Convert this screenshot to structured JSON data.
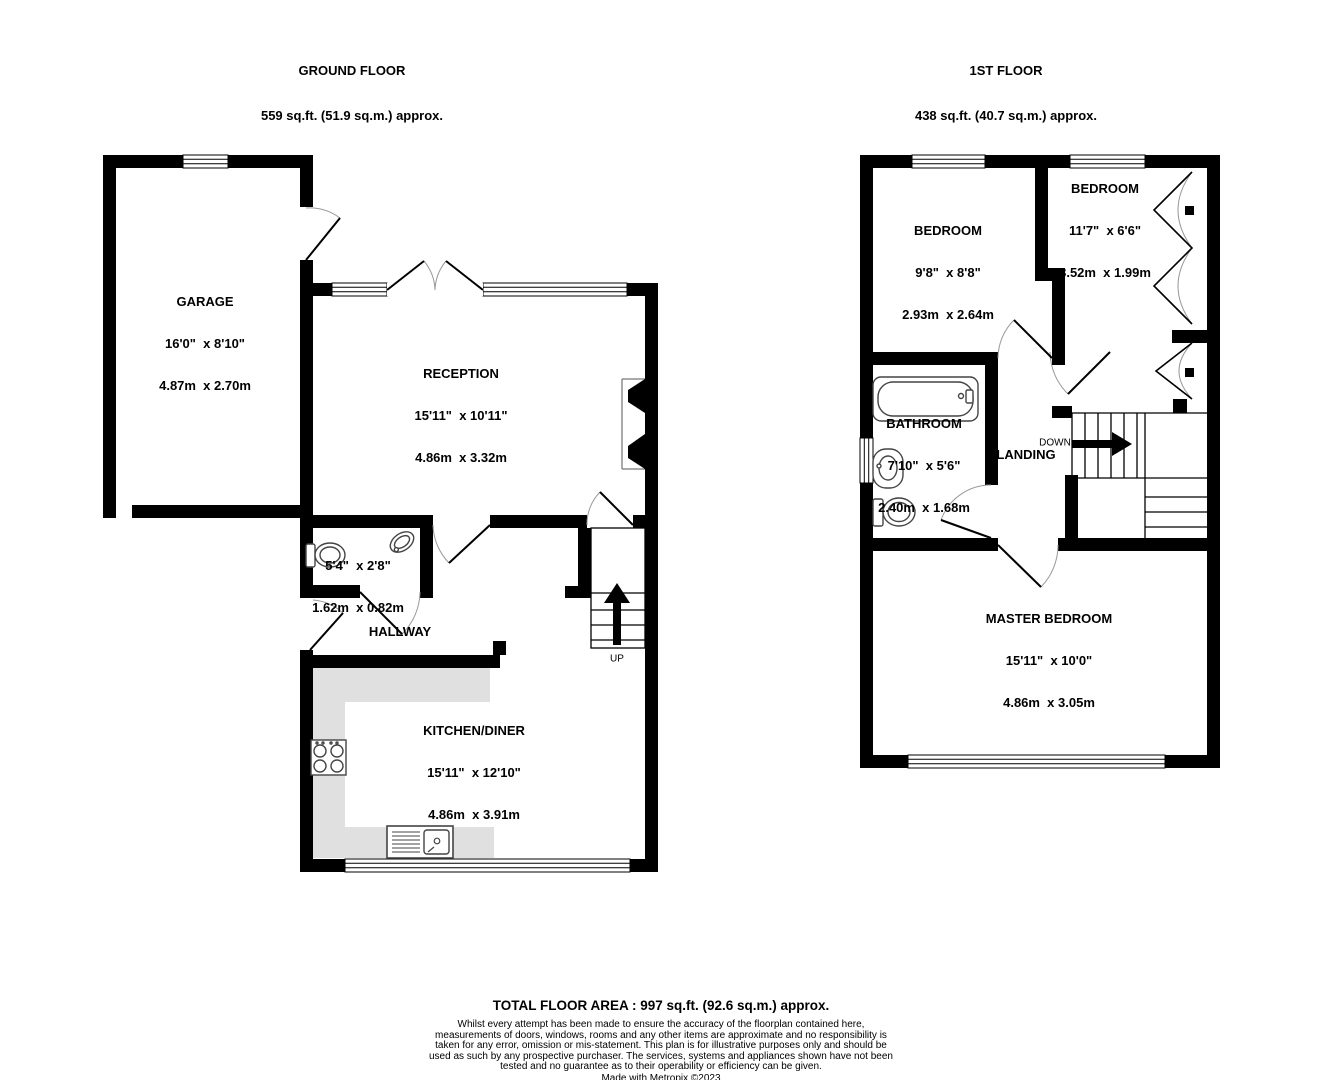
{
  "colors": {
    "wall": "#000000",
    "counter": "#e0e0e0",
    "arc": "#999999"
  },
  "ground_floor": {
    "title": "GROUND FLOOR",
    "area": "559 sq.ft. (51.9 sq.m.) approx.",
    "rooms": {
      "garage": {
        "name": "GARAGE",
        "imperial": "16'0\"  x 8'10\"",
        "metric": "4.87m  x 2.70m"
      },
      "reception": {
        "name": "RECEPTION",
        "imperial": "15'11\"  x 10'11\"",
        "metric": "4.86m  x 3.32m"
      },
      "wc": {
        "name": "WC",
        "imperial": "5'4\"  x 2'8\"",
        "metric": "1.62m  x 0.82m"
      },
      "hallway": {
        "name": "HALLWAY"
      },
      "kitchen_diner": {
        "name": "KITCHEN/DINER",
        "imperial": "15'11\"  x 12'10\"",
        "metric": "4.86m  x 3.91m"
      }
    },
    "stairs_label": "UP"
  },
  "first_floor": {
    "title": "1ST FLOOR",
    "area": "438 sq.ft. (40.7 sq.m.) approx.",
    "rooms": {
      "bedroom_left": {
        "name": "BEDROOM",
        "imperial": "9'8\"  x 8'8\"",
        "metric": "2.93m  x 2.64m"
      },
      "bedroom_right": {
        "name": "BEDROOM",
        "imperial": "11'7\"  x 6'6\"",
        "metric": "3.52m  x 1.99m"
      },
      "bathroom": {
        "name": "BATHROOM",
        "imperial": "7'10\"  x 5'6\"",
        "metric": "2.40m  x 1.68m"
      },
      "landing": {
        "name": "LANDING"
      },
      "master_bedroom": {
        "name": "MASTER BEDROOM",
        "imperial": "15'11\"  x 10'0\"",
        "metric": "4.86m  x 3.05m"
      }
    },
    "stairs_label": "DOWN"
  },
  "footer": {
    "total_area": "TOTAL FLOOR AREA : 997 sq.ft. (92.6 sq.m.) approx.",
    "disclaimer": "Whilst every attempt has been made to ensure the accuracy of the floorplan contained here, measurements of doors, windows, rooms and any other items are approximate and no responsibility is taken for any error, omission or mis-statement. This plan is for illustrative purposes only and should be used as such by any prospective purchaser. The services, systems and appliances shown have not been tested and no guarantee as to their operability or efficiency can be given.",
    "credit": "Made with Metropix ©2023"
  }
}
